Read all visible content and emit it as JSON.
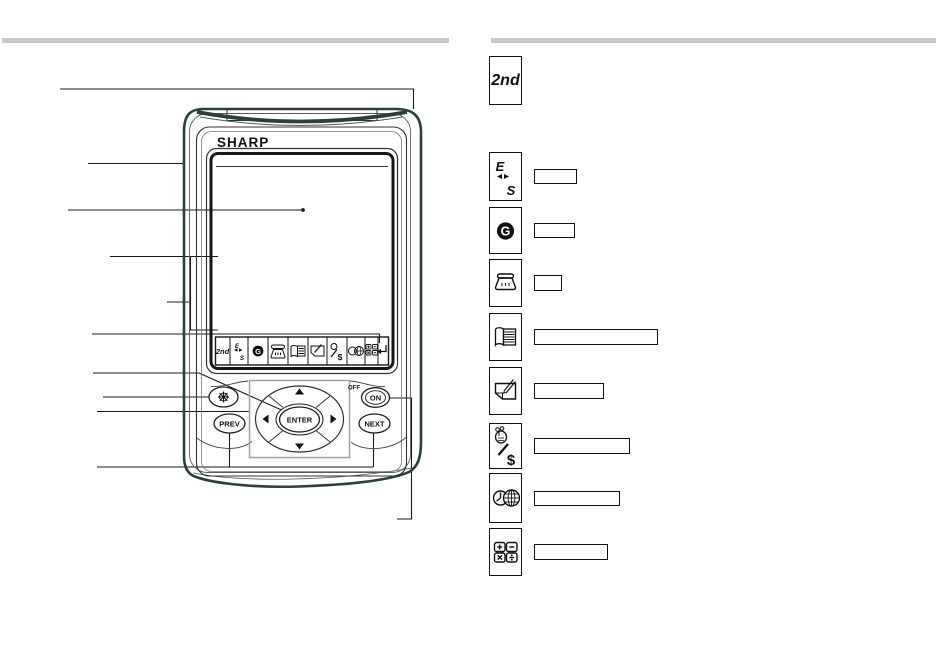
{
  "page": {
    "background": "#ffffff",
    "rule_color": "#c9c9c9"
  },
  "device_diagram": {
    "brand": "SHARP",
    "nav": {
      "enter": "ENTER",
      "prev": "PREV",
      "next": "NEXT",
      "on": "ON",
      "off": "OFF"
    },
    "touch_keys": {
      "second": "2nd",
      "e": "E",
      "s": "S",
      "g": "G",
      "dollar": "$",
      "icons": [
        "2nd-key",
        "english-spanish-key",
        "clock-key",
        "phone-key",
        "phonebook-key",
        "memo-key",
        "schedule-money-key",
        "world-clock-key",
        "calculator-key",
        "enter-key"
      ]
    }
  },
  "legend": {
    "second_key": "2nd",
    "rows": [
      {
        "icon": "english-spanish-key",
        "e": "E",
        "s": "S",
        "label": ""
      },
      {
        "icon": "clock-key",
        "g": "G",
        "label": ""
      },
      {
        "icon": "phone-key",
        "label": ""
      },
      {
        "icon": "phonebook-key",
        "label": ""
      },
      {
        "icon": "memo-key",
        "label": ""
      },
      {
        "icon": "schedule-money-key",
        "dollar": "$",
        "label": ""
      },
      {
        "icon": "world-clock-key",
        "label": ""
      },
      {
        "icon": "calculator-key",
        "label": ""
      }
    ]
  }
}
